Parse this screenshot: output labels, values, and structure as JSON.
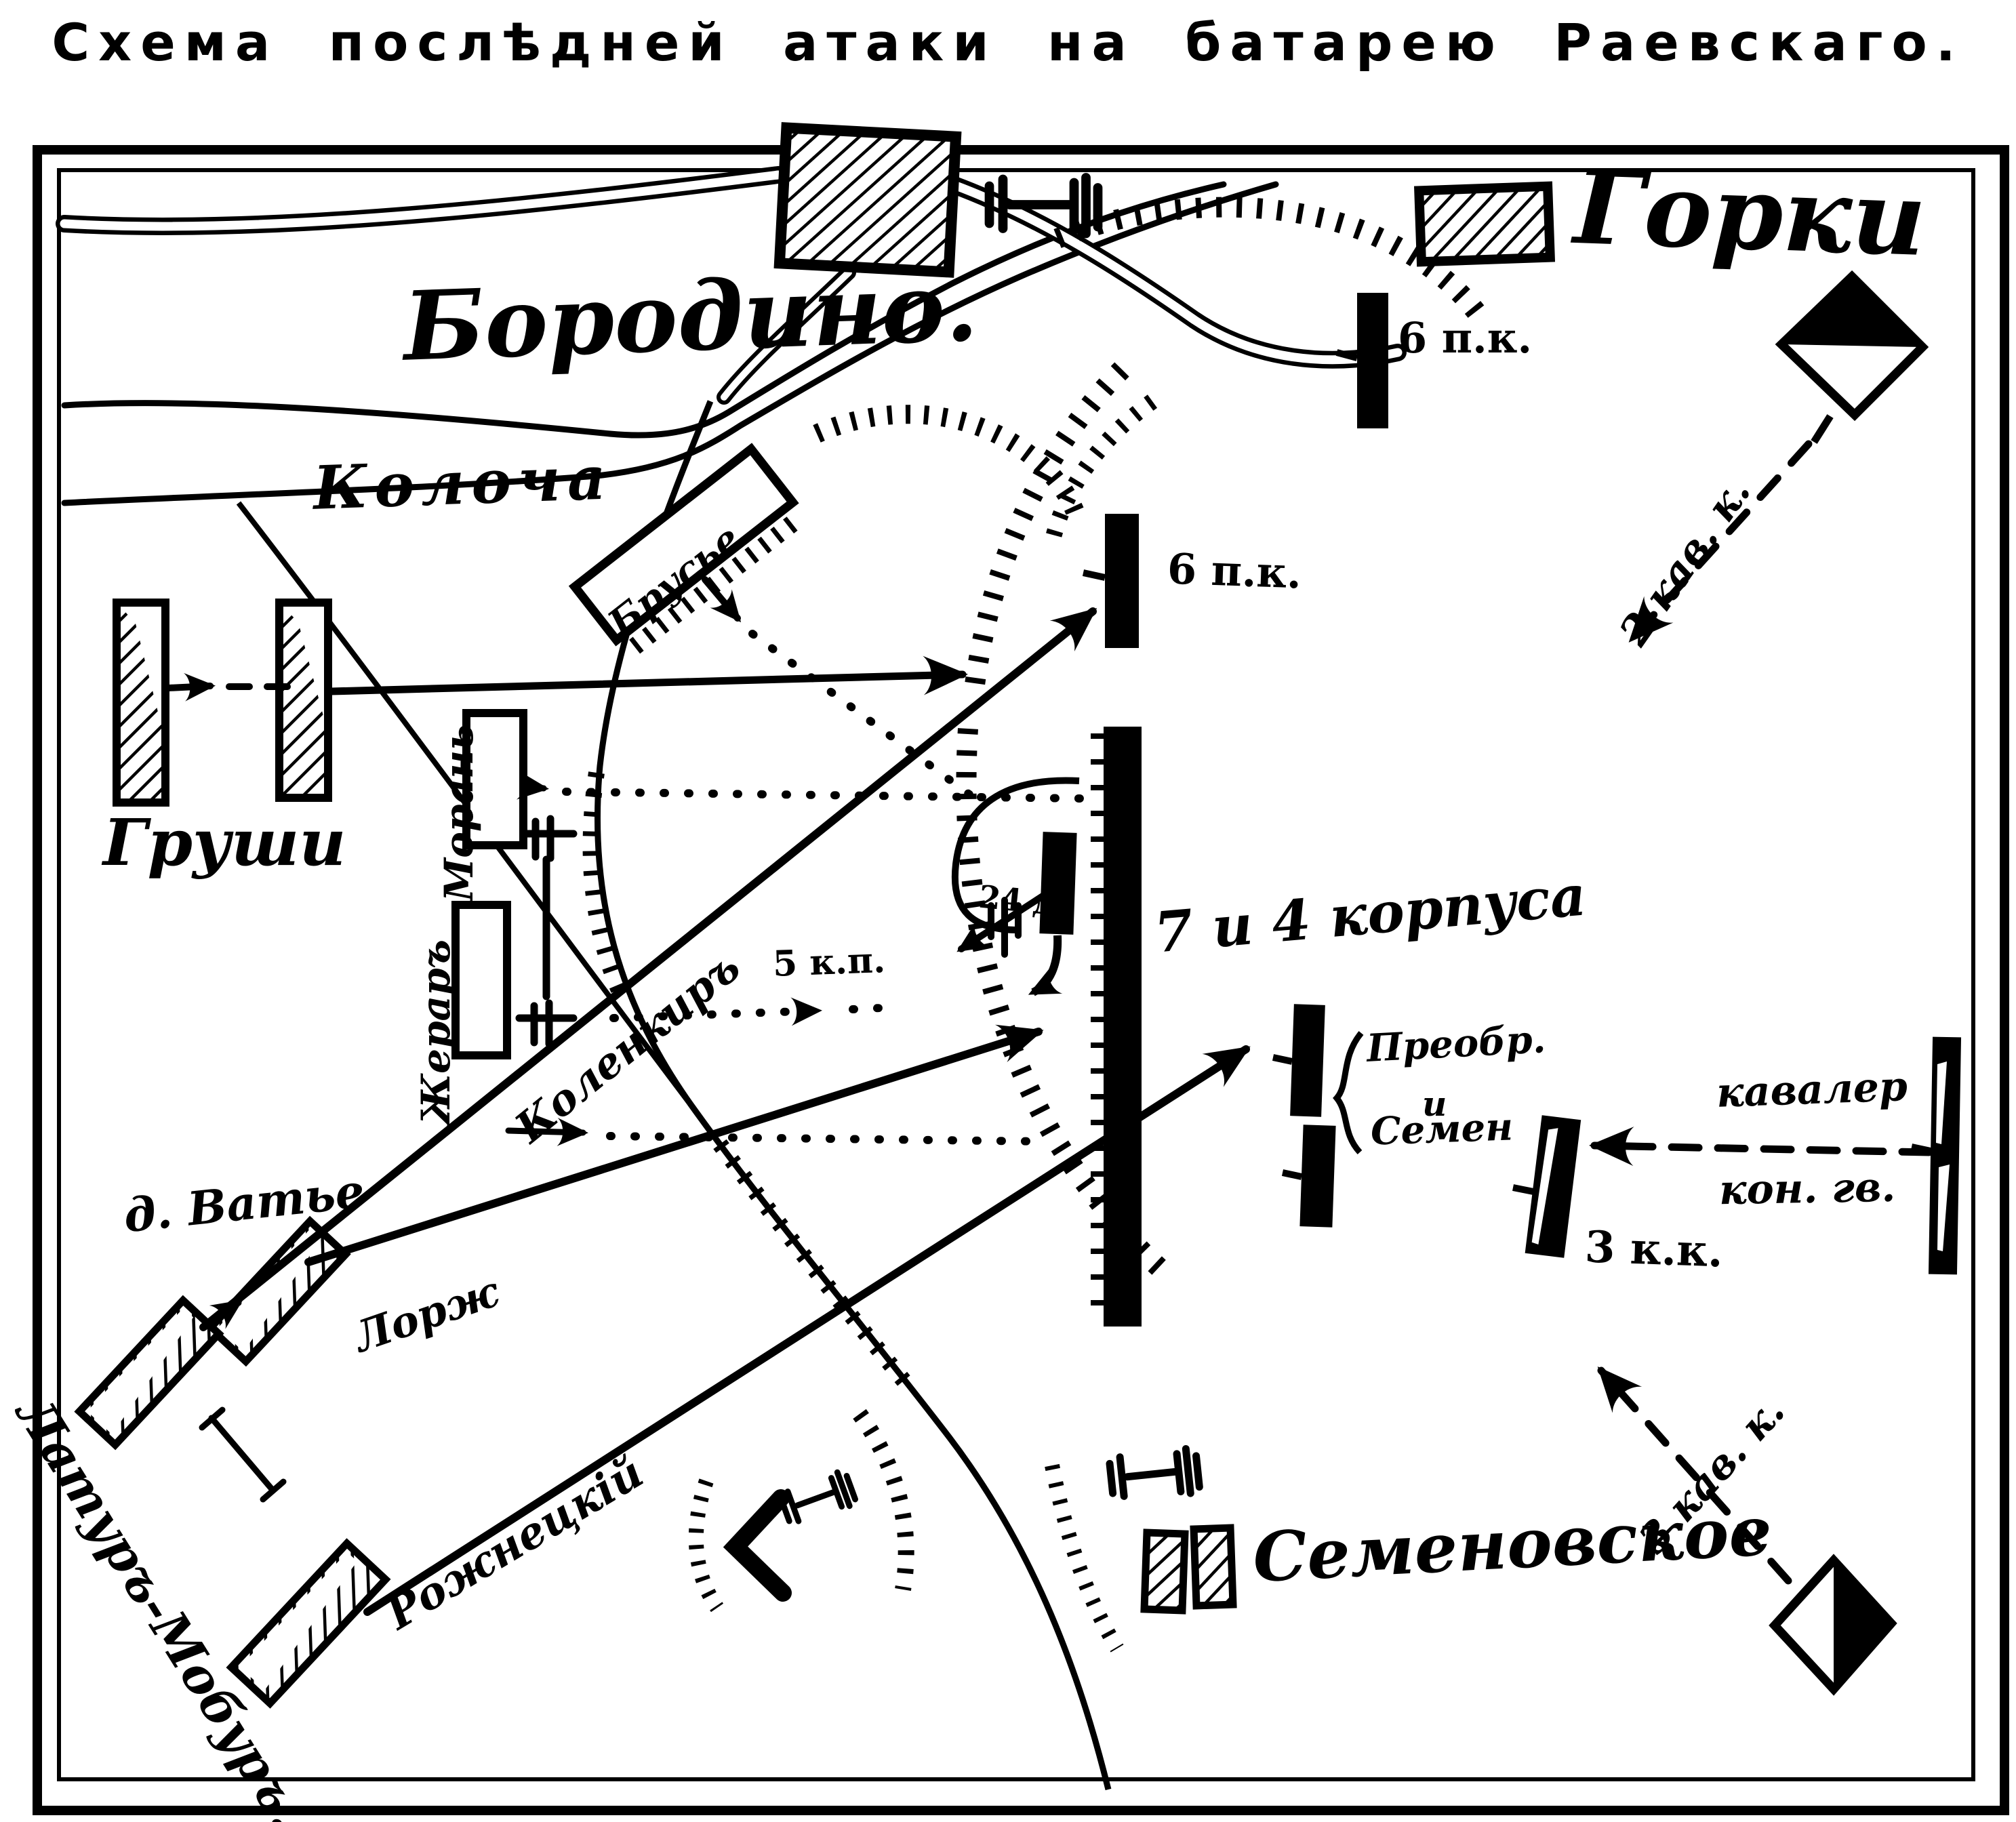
{
  "title": "Схема послѣдней атаки на батарею Раевскаго.",
  "colors": {
    "ink": "#000000",
    "paper": "#ffffff"
  },
  "map": {
    "villages": {
      "borodino": "Бородино.",
      "gorki": "Горки",
      "semenovskoe": "Семеновское"
    },
    "river_label": "Колоча",
    "french_units": {
      "grushi": "Груши",
      "morand": "Морань",
      "gerard": "Жераръ",
      "broussier": "Брусье",
      "vatie": "д. Ватье",
      "latour_maubourg": "Латуръ-Мобуръ.",
      "lorge": "Лорж",
      "rozniecki": "Рожнецкій",
      "caulaincourt": "Коленкиръ",
      "kp5": "5 к.п."
    },
    "russian_units": {
      "pk6": "6 п.к.",
      "div24": "24 д.",
      "korpusa": "7 и 4 корпуса",
      "preobr": "Преобр.",
      "i_conj": "и",
      "semen": "Семен",
      "kav2": "2 кав. к.",
      "kav3": "3 кав. к.",
      "kk3": "3 к.к.",
      "kavaler": "кавалер",
      "kon_gv": "кон. гв."
    },
    "icons": {
      "village_block": "hatched-rectangle-building",
      "cannon": "artillery-battery-symbol",
      "cavalry_diamond": "half-shaded-diamond-standard",
      "redoubt_bar": "solid-black-position-bar",
      "fortification_chevron": "chevron-redoubt",
      "attack_arrow": "solid-arrow",
      "march_arrow_dashed": "dashed-arrow",
      "march_arrow_dotted": "dotted-arrow"
    }
  }
}
